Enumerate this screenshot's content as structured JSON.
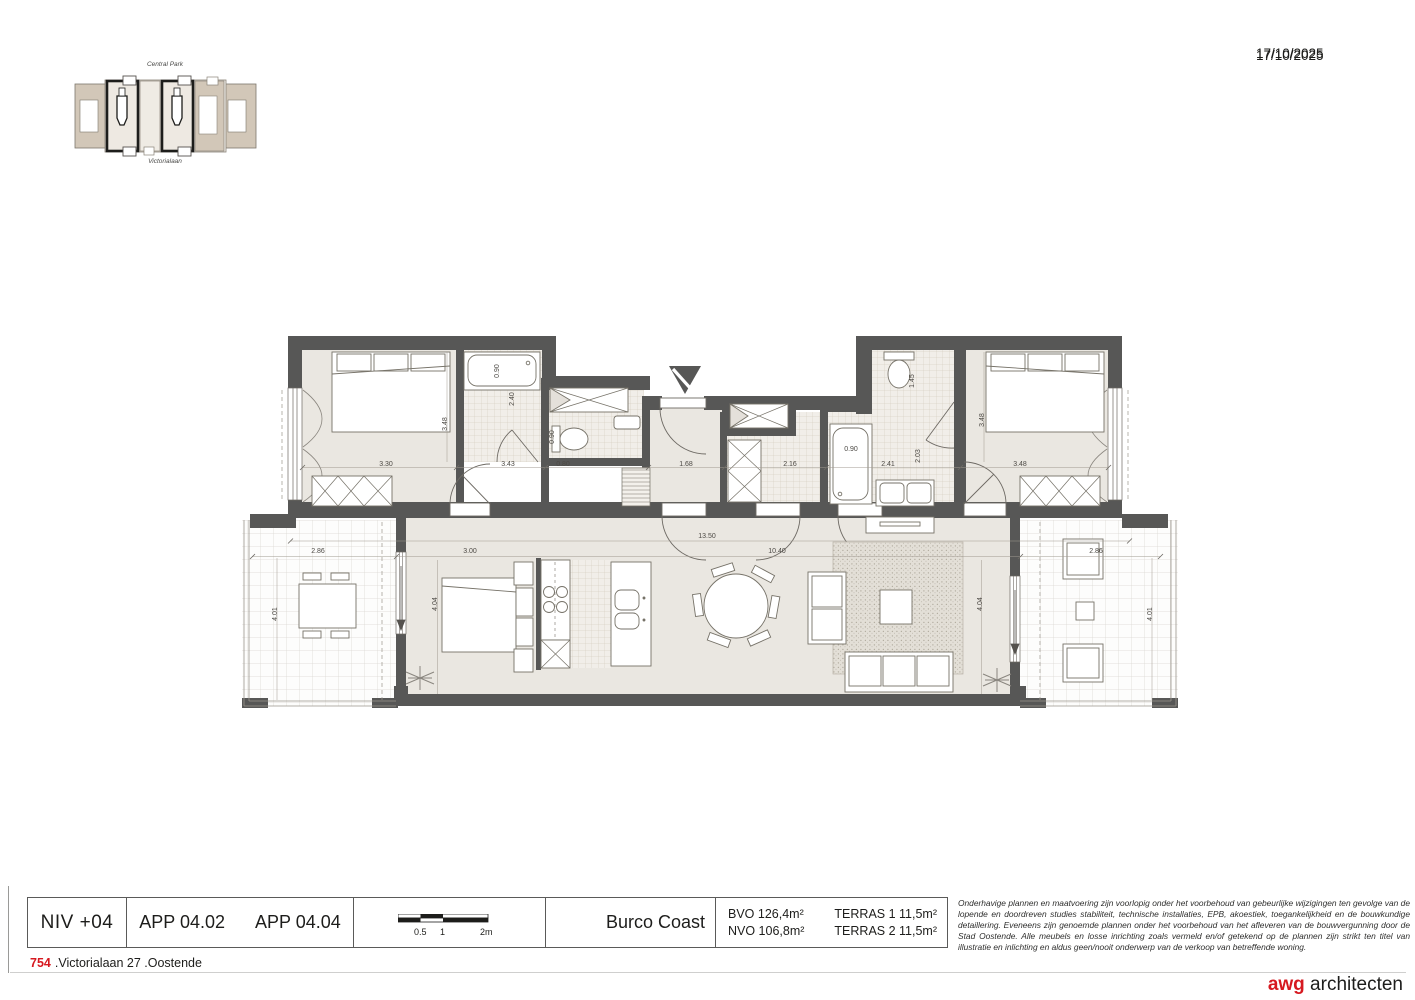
{
  "sheet": {
    "date": "17/10/2025"
  },
  "site_map": {
    "top_label": "Central Park",
    "bottom_label": "Victorialaan"
  },
  "plan": {
    "dimensions": [
      {
        "t": "3.30",
        "x": 386,
        "y": 466
      },
      {
        "t": "3.43",
        "x": 508,
        "y": 466
      },
      {
        "t": "0.80",
        "x": 563,
        "y": 466
      },
      {
        "t": "1.68",
        "x": 686,
        "y": 466
      },
      {
        "t": "2.16",
        "x": 790,
        "y": 466
      },
      {
        "t": "2.41",
        "x": 888,
        "y": 466
      },
      {
        "t": "3.48",
        "x": 1020,
        "y": 466
      },
      {
        "t": "3.48",
        "x": 447,
        "y": 424,
        "r": 1
      },
      {
        "t": "0.90",
        "x": 499,
        "y": 371,
        "r": 1
      },
      {
        "t": "2.40",
        "x": 514,
        "y": 399,
        "r": 1
      },
      {
        "t": "0.90",
        "x": 554,
        "y": 437,
        "r": 1
      },
      {
        "t": "0.90",
        "x": 851,
        "y": 451
      },
      {
        "t": "1.45",
        "x": 914,
        "y": 381,
        "r": 1
      },
      {
        "t": "2.03",
        "x": 920,
        "y": 456,
        "r": 1
      },
      {
        "t": "3.48",
        "x": 984,
        "y": 420,
        "r": 1
      },
      {
        "t": "13.50",
        "x": 707,
        "y": 538
      },
      {
        "t": "10.40",
        "x": 777,
        "y": 553
      },
      {
        "t": "3.00",
        "x": 470,
        "y": 553
      },
      {
        "t": "2.86",
        "x": 318,
        "y": 553
      },
      {
        "t": "2.86",
        "x": 1096,
        "y": 553
      },
      {
        "t": "4.04",
        "x": 437,
        "y": 604,
        "r": 1
      },
      {
        "t": "4.04",
        "x": 982,
        "y": 604,
        "r": 1
      },
      {
        "t": "4.01",
        "x": 277,
        "y": 614,
        "r": 1
      },
      {
        "t": "4.01",
        "x": 1152,
        "y": 614,
        "r": 1
      }
    ]
  },
  "title_block": {
    "level": "NIV +04",
    "apartment_1": "APP 04.02",
    "apartment_2": "APP 04.04",
    "scale_ticks": [
      "0.5",
      "1",
      "2m"
    ],
    "project": "Burco Coast",
    "area_bvo": "BVO 126,4m²",
    "area_nvo": "NVO 106,8m²",
    "area_terras1": "TERRAS 1 11,5m²",
    "area_terras2": "TERRAS 2 11,5m²",
    "disclaimer": "Onderhavige plannen en maatvoering zijn voorlopig onder het voorbehoud van gebeurlijke wijzigingen ten gevolge van de lopende en doordreven studies stabiliteit, technische installaties, EPB, akoestiek, toegankelijkheid en de bouwkundige detaillering. Eveneens zijn genoemde plannen onder het voorbehoud van het afleveren van de bouwvergunning door de Stad Oostende. Alle meubels en losse inrichting zoals vermeld en/of getekend op de plannen zijn strikt ten titel van illustratie en inlichting en aldus geen/nooit onderwerp van de verkoop van betreffende woning.",
    "project_number": "754",
    "address": ".Victorialaan 27 .Oostende",
    "firm_brand": "awg",
    "firm_name": "architecten"
  }
}
